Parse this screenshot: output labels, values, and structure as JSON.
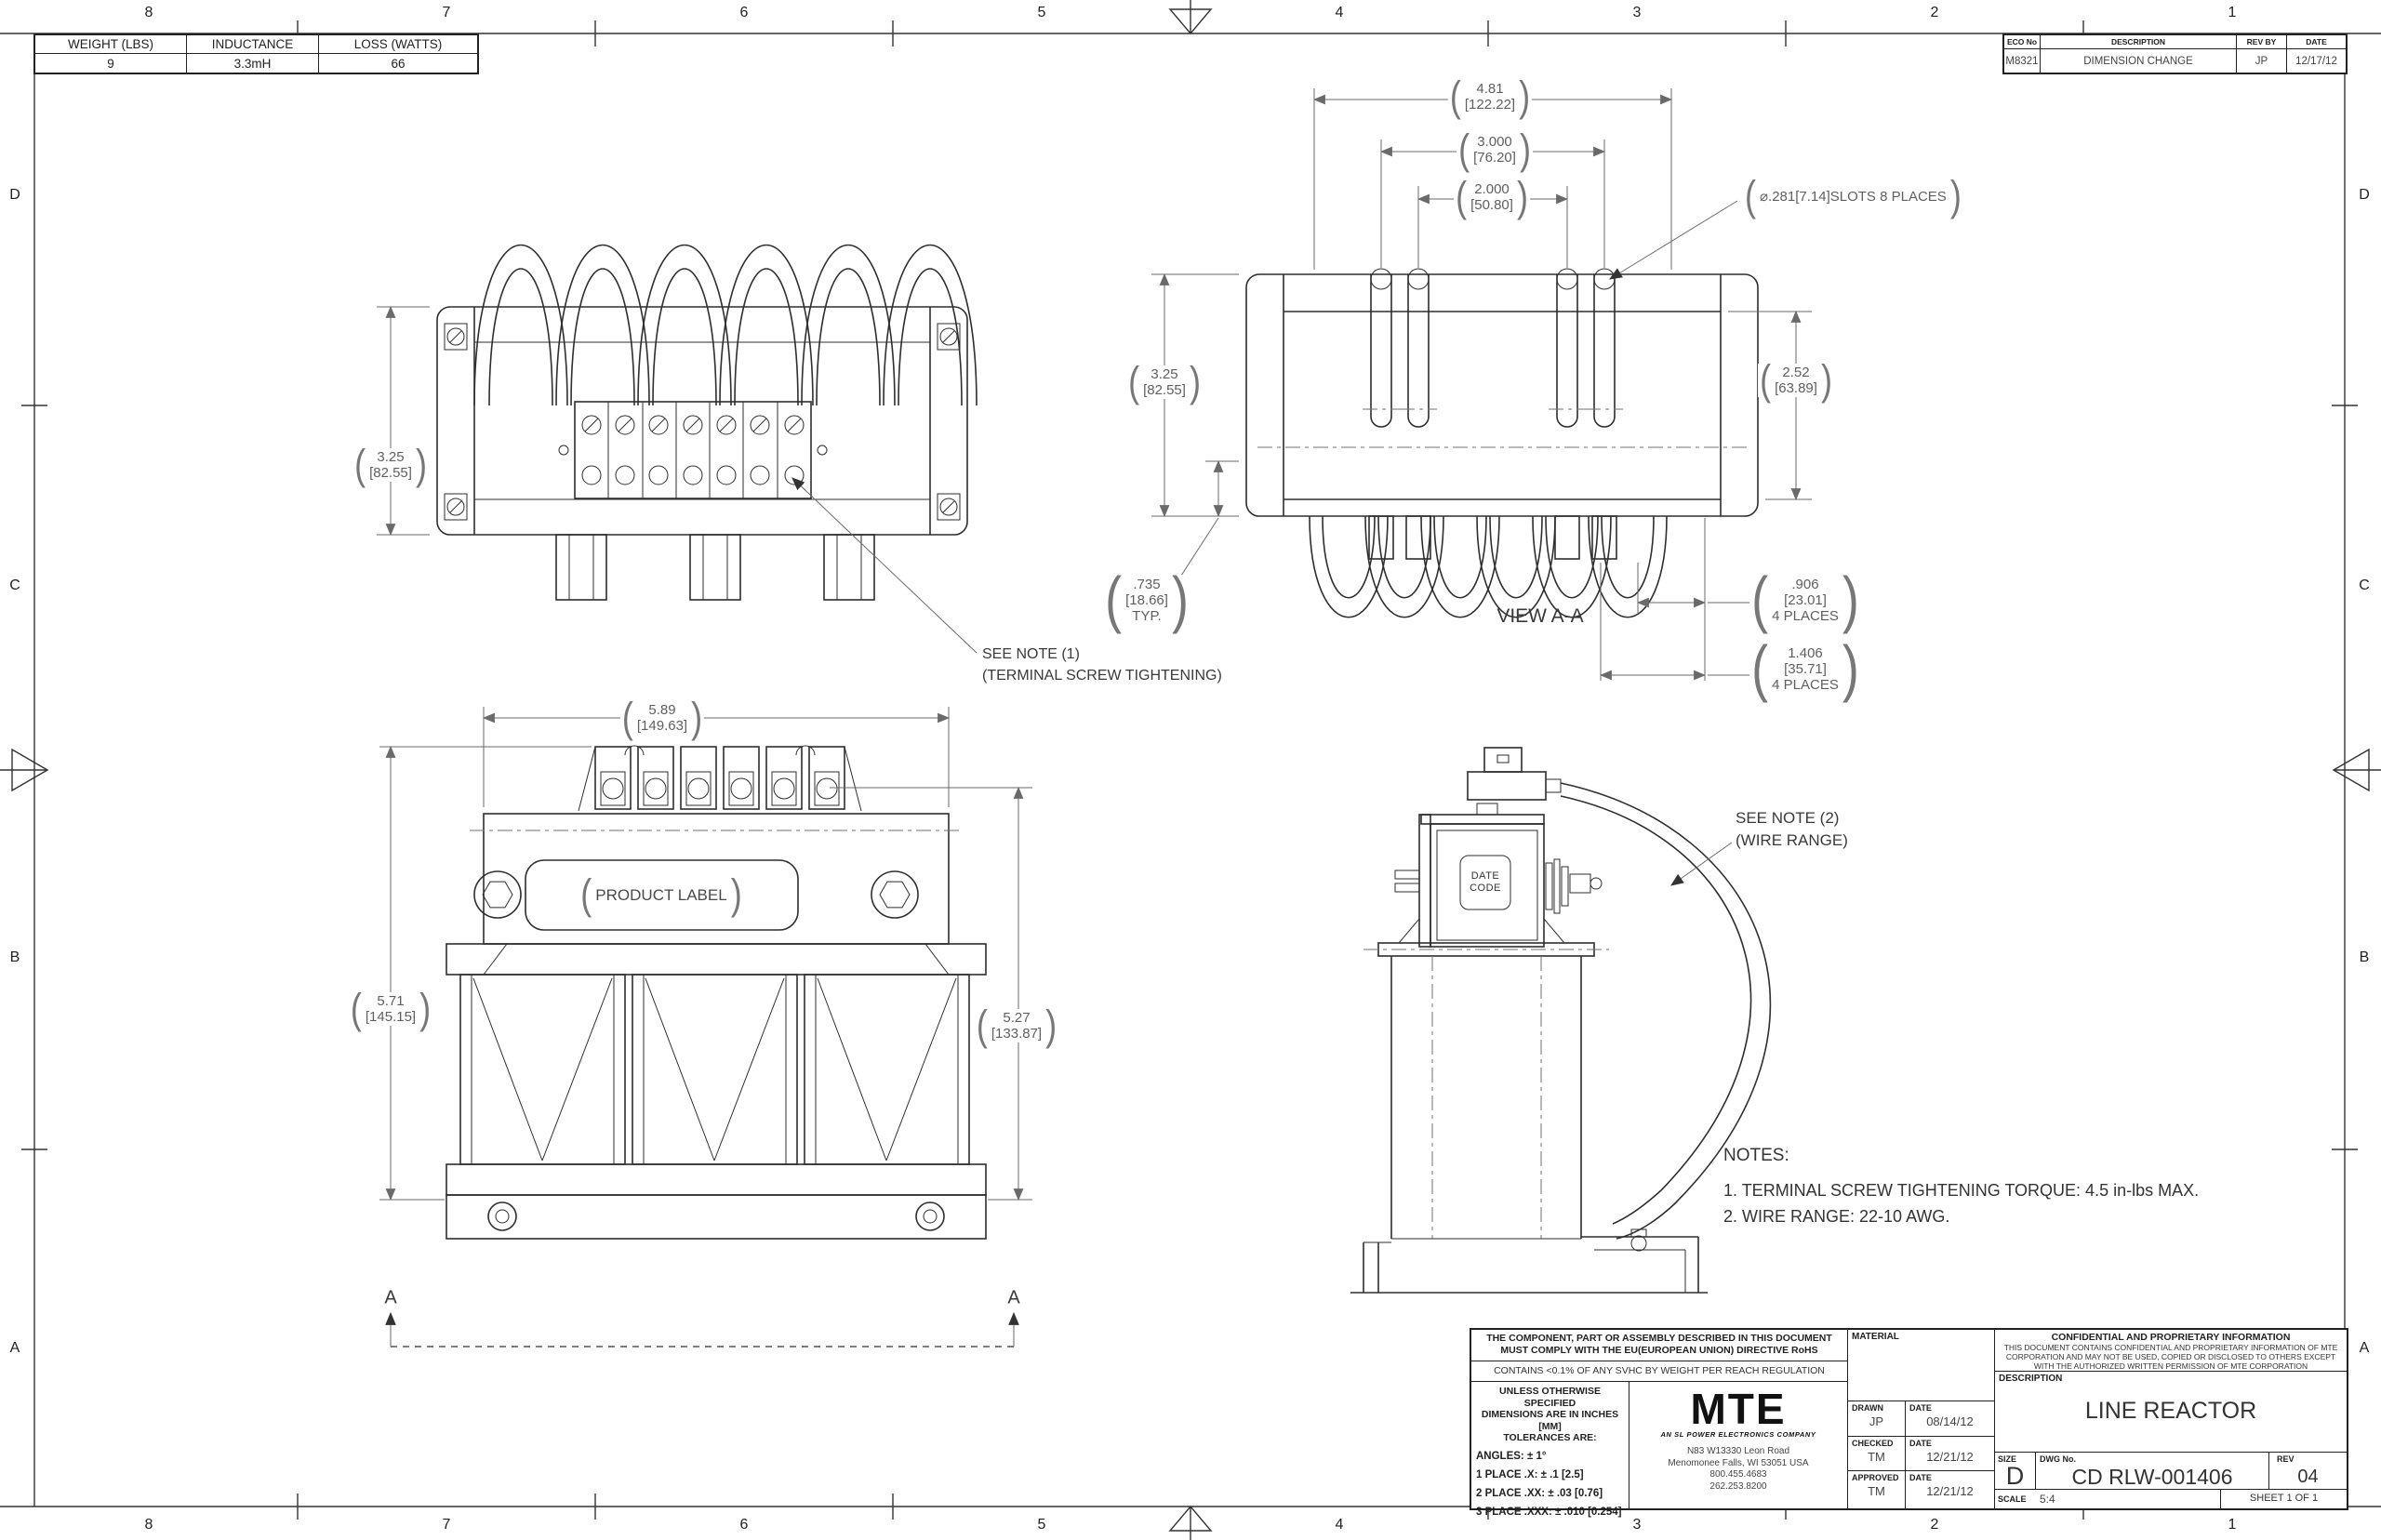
{
  "zones": {
    "columns": [
      "8",
      "7",
      "6",
      "5",
      "4",
      "3",
      "2",
      "1"
    ],
    "rows": [
      "D",
      "C",
      "B",
      "A"
    ]
  },
  "spec_table": {
    "headers": [
      "WEIGHT (LBS)",
      "INDUCTANCE",
      "LOSS (WATTS)"
    ],
    "values": [
      "9",
      "3.3mH",
      "66"
    ]
  },
  "eco_table": {
    "headers": [
      "ECO No",
      "DESCRIPTION",
      "REV BY",
      "DATE"
    ],
    "values": [
      "M8321",
      "DIMENSION CHANGE",
      "JP",
      "12/17/12"
    ]
  },
  "dims": {
    "overall_width": {
      "in": "4.81",
      "mm": "[122.22]"
    },
    "slot_span_outer": {
      "in": "3.000",
      "mm": "[76.20]"
    },
    "slot_span_inner": {
      "in": "2.000",
      "mm": "[50.80]"
    },
    "slot_callout": "⌀.281[7.14]SLOTS 8 PLACES",
    "height_top_view": {
      "in": "3.25",
      "mm": "[82.55]"
    },
    "height_view_aa": {
      "in": "3.25",
      "mm": "[82.55]"
    },
    "core_height": {
      "in": "2.52",
      "mm": "[63.89]"
    },
    "foot_offset": {
      "in": ".735",
      "mm": "[18.66]",
      "note": "TYP."
    },
    "tab_width": {
      "in": ".906",
      "mm": "[23.01]",
      "note": "4 PLACES"
    },
    "tab_spacing": {
      "in": "1.406",
      "mm": "[35.71]",
      "note": "4 PLACES"
    },
    "front_width": {
      "in": "5.89",
      "mm": "[149.63]"
    },
    "front_height_left": {
      "in": "5.71",
      "mm": "[145.15]"
    },
    "front_height_right": {
      "in": "5.27",
      "mm": "[133.87]"
    }
  },
  "callouts": {
    "view_aa": "VIEW A-A",
    "note1_line1": "SEE NOTE (1)",
    "note1_line2": "(TERMINAL SCREW TIGHTENING)",
    "note2_line1": "SEE NOTE (2)",
    "note2_line2": "(WIRE RANGE)",
    "product_label": "PRODUCT LABEL",
    "date_code_line1": "DATE",
    "date_code_line2": "CODE",
    "section_marker": "A"
  },
  "notes": {
    "title": "NOTES:",
    "items": [
      "1.  TERMINAL SCREW TIGHTENING TORQUE: 4.5 in-lbs MAX.",
      "2.  WIRE RANGE: 22-10 AWG."
    ]
  },
  "title_block": {
    "rohs_line1": "THE COMPONENT, PART OR ASSEMBLY DESCRIBED IN THIS DOCUMENT",
    "rohs_line2": "MUST COMPLY WITH THE EU(EUROPEAN UNION) DIRECTIVE RoHS",
    "reach": "CONTAINS <0.1% OF ANY SVHC BY WEIGHT PER REACH REGULATION",
    "tol_header_line1": "UNLESS OTHERWISE SPECIFIED",
    "tol_header_line2": "DIMENSIONS ARE IN INCHES [MM]",
    "tol_header_line3": "TOLERANCES ARE:",
    "tol_angles": "ANGLES: ± 1°",
    "tol_1place": "1 PLACE .X: ± .1 [2.5]",
    "tol_2place": "2 PLACE .XX: ± .03 [0.76]",
    "tol_3place": "3 PLACE .XXX: ± .010 [0.254]",
    "logo_text": "MTE",
    "logo_tagline": "AN SL POWER ELECTRONICS COMPANY",
    "address_line1": "N83 W13330 Leon Road",
    "address_line2": "Menomonee Falls, WI 53051 USA",
    "address_line3": "800.455.4683",
    "address_line4": "262.253.8200",
    "material_label": "MATERIAL",
    "drawn_label": "DRAWN",
    "drawn_by": "JP",
    "drawn_date": "08/14/12",
    "checked_label": "CHECKED",
    "checked_by": "TM",
    "checked_date": "12/21/12",
    "approved_label": "APPROVED",
    "approved_by": "TM",
    "approved_date": "12/21/12",
    "date_label": "DATE",
    "conf_title": "CONFIDENTIAL AND PROPRIETARY INFORMATION",
    "conf_line1": "THIS DOCUMENT CONTAINS CONFIDENTIAL AND PROPRIETARY INFORMATION OF MTE",
    "conf_line2": "CORPORATION AND MAY NOT BE USED, COPIED OR DISCLOSED TO OTHERS EXCEPT",
    "conf_line3": "WITH THE AUTHORIZED WRITTEN PERMISSION OF MTE CORPORATION",
    "description_label": "DESCRIPTION",
    "description": "LINE REACTOR",
    "size_label": "SIZE",
    "size": "D",
    "dwg_label": "DWG No.",
    "dwg_no": "CD RLW-001406",
    "rev_label": "REV",
    "rev": "04",
    "scale_label": "SCALE",
    "scale": "5:4",
    "sheet": "SHEET 1  OF 1"
  }
}
